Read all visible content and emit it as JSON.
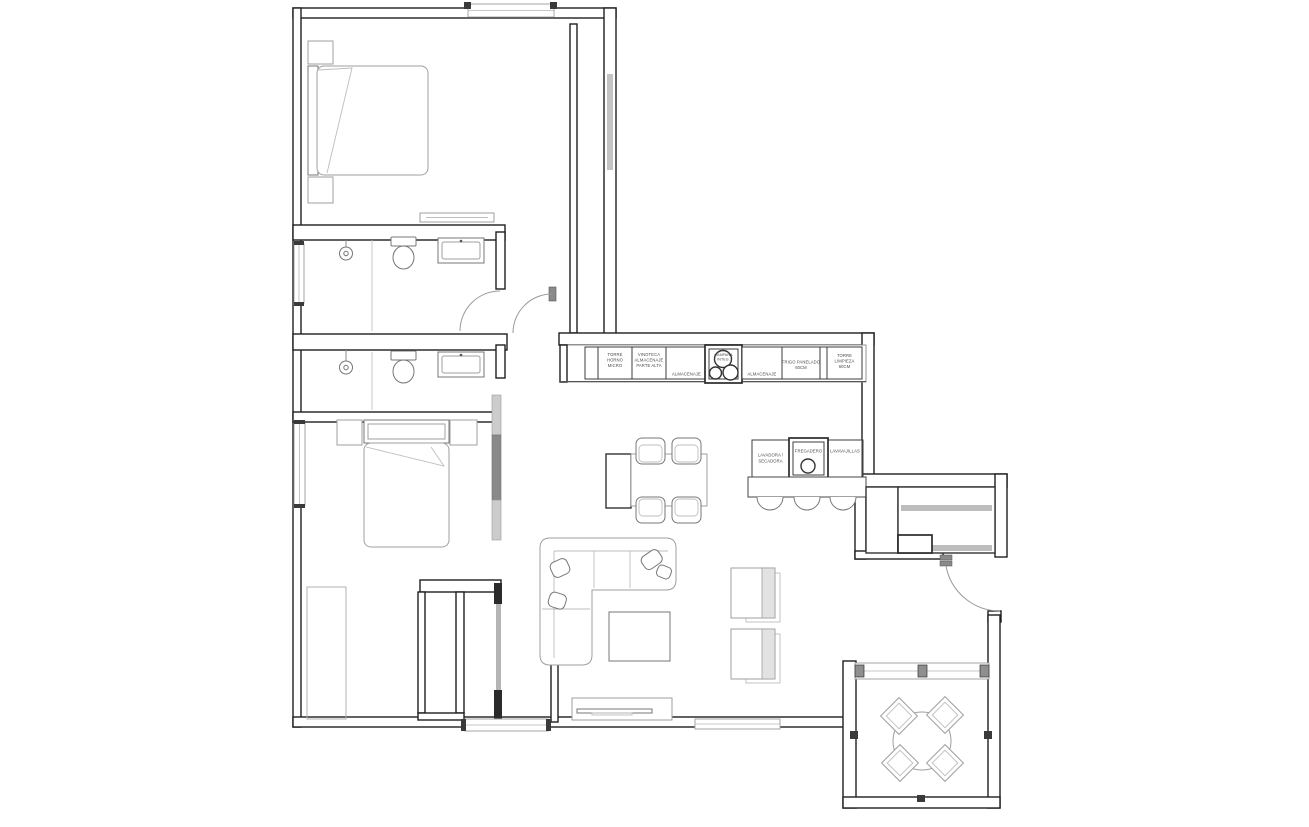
{
  "palette": {
    "background": "#ffffff",
    "wall_line": "#1e1e1e",
    "furniture_light": "#9f9f9f",
    "furniture_mid": "#777777",
    "cabinet_line": "#3c3c3c",
    "glass_gray": "#a6a6a6",
    "label_text": "#4a4a4a",
    "sliding_panel": "#8a8a8a"
  },
  "kitchen": {
    "cabinets": [
      {
        "name": "torre-horno-micro",
        "lines": [
          "TORRE",
          "HORNO",
          "MICRO"
        ]
      },
      {
        "name": "vinoteca-almacenaje",
        "lines": [
          "VINOTECA",
          "ALMACENAJE",
          "PARTE ALTA"
        ]
      },
      {
        "name": "almacenaje-1",
        "lines": [
          "ALMACENAJE"
        ]
      },
      {
        "name": "campana",
        "lines": [
          "CAMPANA",
          "INTEG."
        ]
      },
      {
        "name": "almacenaje-2",
        "lines": [
          "ALMACENAJE"
        ]
      },
      {
        "name": "frigo-panelado",
        "lines": [
          "FRIGO PANELADO",
          "60CM"
        ]
      },
      {
        "name": "torre-limpieza",
        "lines": [
          "TORRE",
          "LIMPIEZA",
          "60CM"
        ]
      }
    ]
  },
  "island": {
    "units": [
      {
        "name": "lavadora-secadora",
        "lines": [
          "LAVADORA /",
          "SECADORA"
        ]
      },
      {
        "name": "fregadero",
        "lines": [
          "FREGADERO"
        ]
      },
      {
        "name": "lavavajillas",
        "lines": [
          "LAVAVAJILLAS"
        ]
      }
    ]
  }
}
